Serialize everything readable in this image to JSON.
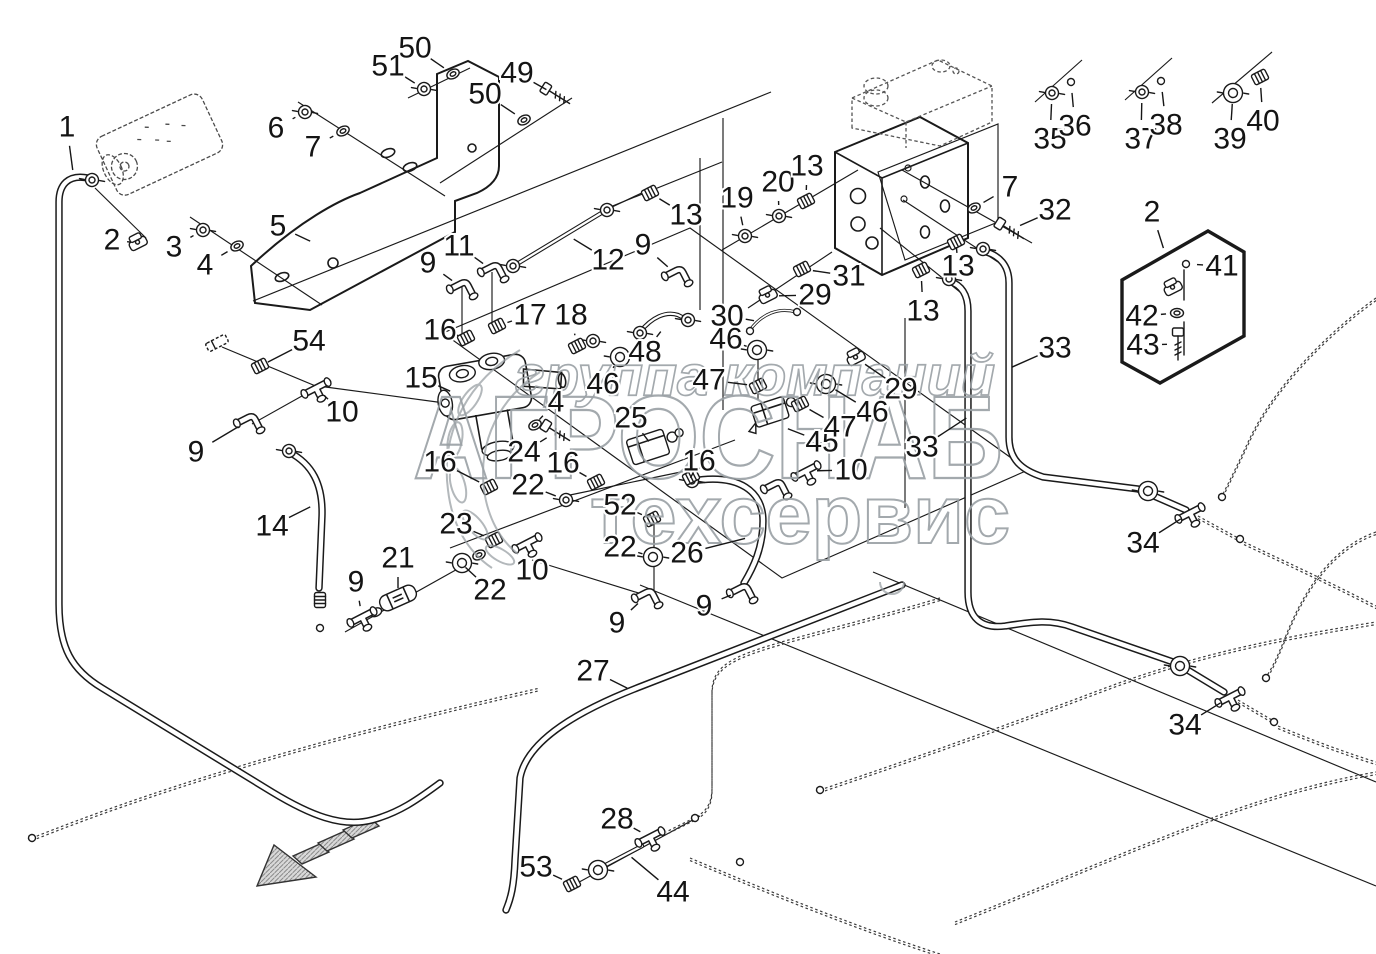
{
  "diagram": {
    "kind": "exploded-parts-diagram",
    "subject": "hydraulic pipes, hoses and fittings assembly",
    "watermark": {
      "line1": "группа компаний",
      "line2": "АГРОСНАБ",
      "line3": "техсервис",
      "color": "#9aa0a5"
    },
    "direction_arrow": {
      "present": true,
      "x": 300,
      "y": 858,
      "pointing": "lower-left"
    },
    "callouts": [
      {
        "n": "1",
        "x": 67,
        "y": 127,
        "tx": 73,
        "ty": 172,
        "g": "none"
      },
      {
        "n": "2",
        "x": 112,
        "y": 240,
        "tx": 138,
        "ty": 243,
        "g": "clamp"
      },
      {
        "n": "3",
        "x": 174,
        "y": 247,
        "tx": 203,
        "ty": 230,
        "g": "nut"
      },
      {
        "n": "4",
        "x": 205,
        "y": 265,
        "tx": 237,
        "ty": 246,
        "g": "washer"
      },
      {
        "n": "5",
        "x": 278,
        "y": 226,
        "tx": 312,
        "ty": 242,
        "g": "none"
      },
      {
        "n": "6",
        "x": 276,
        "y": 128,
        "tx": 305,
        "ty": 112,
        "g": "nut"
      },
      {
        "n": "7",
        "x": 313,
        "y": 147,
        "tx": 343,
        "ty": 131,
        "g": "washer"
      },
      {
        "n": "50",
        "x": 415,
        "y": 48,
        "tx": 453,
        "ty": 74,
        "g": "washer"
      },
      {
        "n": "51",
        "x": 388,
        "y": 66,
        "tx": 424,
        "ty": 89,
        "g": "nut"
      },
      {
        "n": "49",
        "x": 517,
        "y": 73,
        "tx": 556,
        "ty": 95,
        "g": "bolt",
        "r": 32
      },
      {
        "n": "50",
        "x": 485,
        "y": 94,
        "tx": 524,
        "ty": 120,
        "g": "washer"
      },
      {
        "n": "9",
        "x": 428,
        "y": 263,
        "tx": 461,
        "ty": 287,
        "g": "elbow"
      },
      {
        "n": "11",
        "x": 459,
        "y": 246,
        "tx": 492,
        "ty": 270,
        "g": "elbow"
      },
      {
        "n": "12",
        "x": 608,
        "y": 260,
        "tx": 572,
        "ty": 238,
        "g": "none"
      },
      {
        "n": "13",
        "x": 686,
        "y": 215,
        "tx": 650,
        "ty": 193,
        "g": "ribbed"
      },
      {
        "n": "9",
        "x": 643,
        "y": 245,
        "tx": 676,
        "ty": 274,
        "g": "elbow"
      },
      {
        "n": "16",
        "x": 440,
        "y": 330,
        "tx": 466,
        "ty": 338,
        "g": "ribbed"
      },
      {
        "n": "17",
        "x": 530,
        "y": 315,
        "tx": 497,
        "ty": 326,
        "g": "ribbed"
      },
      {
        "n": "18",
        "x": 571,
        "y": 315,
        "tx": 577,
        "ty": 346,
        "g": "ribbed"
      },
      {
        "n": "15",
        "x": 421,
        "y": 378,
        "tx": 452,
        "ty": 392,
        "g": "none"
      },
      {
        "n": "54",
        "x": 309,
        "y": 341,
        "tx": 266,
        "ty": 363,
        "g": "none"
      },
      {
        "n": "10",
        "x": 342,
        "y": 412,
        "tx": 316,
        "ty": 388,
        "g": "tee"
      },
      {
        "n": "9",
        "x": 196,
        "y": 452,
        "tx": 248,
        "ty": 421,
        "g": "elbow"
      },
      {
        "n": "14",
        "x": 272,
        "y": 526,
        "tx": 312,
        "ty": 506,
        "g": "none"
      },
      {
        "n": "19",
        "x": 737,
        "y": 198,
        "tx": 745,
        "ty": 236,
        "g": "nut"
      },
      {
        "n": "20",
        "x": 778,
        "y": 182,
        "tx": 779,
        "ty": 216,
        "g": "nut"
      },
      {
        "n": "13",
        "x": 807,
        "y": 166,
        "tx": 806,
        "ty": 201,
        "g": "ribbed"
      },
      {
        "n": "31",
        "x": 849,
        "y": 276,
        "tx": 802,
        "ty": 269,
        "g": "ribbed"
      },
      {
        "n": "29",
        "x": 815,
        "y": 295,
        "tx": 768,
        "ty": 296,
        "g": "clamp"
      },
      {
        "n": "30",
        "x": 727,
        "y": 316,
        "tx": 756,
        "ty": 321,
        "g": "none"
      },
      {
        "n": "46",
        "x": 726,
        "y": 339,
        "tx": 757,
        "ty": 350,
        "g": "bignut"
      },
      {
        "n": "48",
        "x": 645,
        "y": 352,
        "tx": 662,
        "ty": 330,
        "g": "none"
      },
      {
        "n": "46",
        "x": 603,
        "y": 384,
        "tx": 620,
        "ty": 357,
        "g": "bignut"
      },
      {
        "n": "47",
        "x": 709,
        "y": 380,
        "tx": 758,
        "ty": 386,
        "g": "ribbed"
      },
      {
        "n": "4",
        "x": 556,
        "y": 402,
        "tx": 538,
        "ty": 421,
        "g": "none"
      },
      {
        "n": "24",
        "x": 524,
        "y": 452,
        "tx": 556,
        "ty": 432,
        "g": "bolt",
        "r": 32
      },
      {
        "n": "25",
        "x": 631,
        "y": 418,
        "tx": 650,
        "ty": 443,
        "g": "none"
      },
      {
        "n": "16",
        "x": 563,
        "y": 463,
        "tx": 596,
        "ty": 482,
        "g": "ribbed"
      },
      {
        "n": "16",
        "x": 699,
        "y": 461,
        "tx": 691,
        "ty": 477,
        "g": "ribbed"
      },
      {
        "n": "16",
        "x": 440,
        "y": 462,
        "tx": 489,
        "ty": 487,
        "g": "ribbed"
      },
      {
        "n": "22",
        "x": 528,
        "y": 485,
        "tx": 566,
        "ty": 500,
        "g": "nut"
      },
      {
        "n": "52",
        "x": 620,
        "y": 505,
        "tx": 652,
        "ty": 519,
        "g": "ribbed"
      },
      {
        "n": "22",
        "x": 620,
        "y": 547,
        "tx": 653,
        "ty": 557,
        "g": "bignut"
      },
      {
        "n": "26",
        "x": 687,
        "y": 553,
        "tx": 747,
        "ty": 538,
        "g": "none"
      },
      {
        "n": "23",
        "x": 456,
        "y": 524,
        "tx": 494,
        "ty": 540,
        "g": "ribbed"
      },
      {
        "n": "10",
        "x": 532,
        "y": 570,
        "tx": 527,
        "ty": 543,
        "g": "tee"
      },
      {
        "n": "22",
        "x": 490,
        "y": 590,
        "tx": 464,
        "ty": 566,
        "g": "none"
      },
      {
        "n": "9",
        "x": 617,
        "y": 623,
        "tx": 646,
        "ty": 596,
        "g": "elbow"
      },
      {
        "n": "9",
        "x": 704,
        "y": 606,
        "tx": 741,
        "ty": 591,
        "g": "elbow"
      },
      {
        "n": "27",
        "x": 593,
        "y": 671,
        "tx": 629,
        "ty": 689,
        "g": "none"
      },
      {
        "n": "21",
        "x": 398,
        "y": 558,
        "tx": 398,
        "ty": 590,
        "g": "none"
      },
      {
        "n": "9",
        "x": 356,
        "y": 582,
        "tx": 362,
        "ty": 617,
        "g": "tee"
      },
      {
        "n": "34",
        "x": 1143,
        "y": 543,
        "tx": 1190,
        "ty": 513,
        "g": "tee"
      },
      {
        "n": "34",
        "x": 1185,
        "y": 725,
        "tx": 1230,
        "ty": 697,
        "g": "tee"
      },
      {
        "n": "33",
        "x": 1055,
        "y": 348,
        "tx": 1010,
        "ty": 368,
        "g": "none"
      },
      {
        "n": "33",
        "x": 922,
        "y": 447,
        "tx": 968,
        "ty": 417,
        "g": "none"
      },
      {
        "n": "28",
        "x": 617,
        "y": 819,
        "tx": 650,
        "ty": 837,
        "g": "tee"
      },
      {
        "n": "53",
        "x": 536,
        "y": 867,
        "tx": 572,
        "ty": 884,
        "g": "ribbed"
      },
      {
        "n": "44",
        "x": 673,
        "y": 892,
        "tx": 630,
        "ty": 856,
        "g": "none"
      },
      {
        "n": "7",
        "x": 1010,
        "y": 187,
        "tx": 974,
        "ty": 208,
        "g": "washer"
      },
      {
        "n": "32",
        "x": 1055,
        "y": 210,
        "tx": 1010,
        "ty": 230,
        "g": "bolt",
        "r": 32
      },
      {
        "n": "2",
        "x": 1152,
        "y": 212,
        "tx": 1164,
        "ty": 250,
        "g": "none"
      },
      {
        "n": "41",
        "x": 1222,
        "y": 266,
        "tx": 1186,
        "ty": 264,
        "g": "ring"
      },
      {
        "n": "42",
        "x": 1142,
        "y": 316,
        "tx": 1177,
        "ty": 313,
        "g": "washer",
        "r": 0
      },
      {
        "n": "43",
        "x": 1143,
        "y": 345,
        "tx": 1178,
        "ty": 344,
        "g": "bolt",
        "r": 90
      },
      {
        "n": "35",
        "x": 1050,
        "y": 139,
        "tx": 1052,
        "ty": 93,
        "g": "nut"
      },
      {
        "n": "36",
        "x": 1075,
        "y": 126,
        "tx": 1071,
        "ty": 82,
        "g": "ring"
      },
      {
        "n": "37",
        "x": 1141,
        "y": 139,
        "tx": 1142,
        "ty": 92,
        "g": "nut"
      },
      {
        "n": "38",
        "x": 1166,
        "y": 125,
        "tx": 1161,
        "ty": 81,
        "g": "ring"
      },
      {
        "n": "39",
        "x": 1230,
        "y": 139,
        "tx": 1233,
        "ty": 93,
        "g": "bignut"
      },
      {
        "n": "40",
        "x": 1263,
        "y": 121,
        "tx": 1260,
        "ty": 77,
        "g": "ribbed"
      },
      {
        "n": "45",
        "x": 822,
        "y": 442,
        "tx": 786,
        "ty": 428,
        "g": "none"
      },
      {
        "n": "29",
        "x": 901,
        "y": 389,
        "tx": 856,
        "ty": 358,
        "g": "clamp"
      },
      {
        "n": "46",
        "x": 872,
        "y": 412,
        "tx": 826,
        "ty": 384,
        "g": "bignut"
      },
      {
        "n": "47",
        "x": 840,
        "y": 427,
        "tx": 800,
        "ty": 404,
        "g": "ribbed"
      },
      {
        "n": "10",
        "x": 851,
        "y": 470,
        "tx": 806,
        "ty": 471,
        "g": "tee"
      },
      {
        "n": "13",
        "x": 958,
        "y": 266,
        "tx": 956,
        "ty": 242,
        "g": "ribbed"
      },
      {
        "n": "13",
        "x": 923,
        "y": 311,
        "tx": 921,
        "ty": 270,
        "g": "ribbed"
      }
    ],
    "extra_fittings": [
      {
        "x": 92,
        "y": 180,
        "g": "nut"
      },
      {
        "x": 217,
        "y": 343,
        "g": "cap"
      },
      {
        "x": 260,
        "y": 366,
        "g": "ribbed"
      },
      {
        "x": 289,
        "y": 451,
        "g": "nut"
      },
      {
        "x": 320,
        "y": 600,
        "g": "ribbed",
        "r": 90
      },
      {
        "x": 513,
        "y": 266,
        "g": "nut"
      },
      {
        "x": 607,
        "y": 210,
        "g": "nut"
      },
      {
        "x": 593,
        "y": 341,
        "g": "nut"
      },
      {
        "x": 535,
        "y": 425,
        "g": "washer"
      },
      {
        "x": 640,
        "y": 333,
        "g": "nut"
      },
      {
        "x": 688,
        "y": 320,
        "g": "nut"
      },
      {
        "x": 692,
        "y": 481,
        "g": "nut"
      },
      {
        "x": 462,
        "y": 563,
        "g": "bignut"
      },
      {
        "x": 479,
        "y": 555,
        "g": "washer"
      },
      {
        "x": 775,
        "y": 487,
        "g": "elbow"
      },
      {
        "x": 1148,
        "y": 491,
        "g": "bignut"
      },
      {
        "x": 1180,
        "y": 666,
        "g": "bignut"
      },
      {
        "x": 983,
        "y": 249,
        "g": "nut"
      },
      {
        "x": 949,
        "y": 279,
        "g": "nut"
      },
      {
        "x": 32,
        "y": 838,
        "g": "ring"
      },
      {
        "x": 820,
        "y": 790,
        "g": "ring"
      },
      {
        "x": 1222,
        "y": 497,
        "g": "ring"
      },
      {
        "x": 1240,
        "y": 539,
        "g": "ring"
      },
      {
        "x": 1266,
        "y": 678,
        "g": "ring"
      },
      {
        "x": 1274,
        "y": 722,
        "g": "ring"
      },
      {
        "x": 695,
        "y": 818,
        "g": "ring"
      },
      {
        "x": 740,
        "y": 862,
        "g": "ring"
      },
      {
        "x": 1173,
        "y": 288,
        "g": "clamp"
      },
      {
        "x": 598,
        "y": 870,
        "g": "bignut"
      },
      {
        "x": 750,
        "y": 331,
        "g": "ring"
      },
      {
        "x": 797,
        "y": 312,
        "g": "ring"
      },
      {
        "x": 320,
        "y": 628,
        "g": "ring"
      }
    ]
  }
}
